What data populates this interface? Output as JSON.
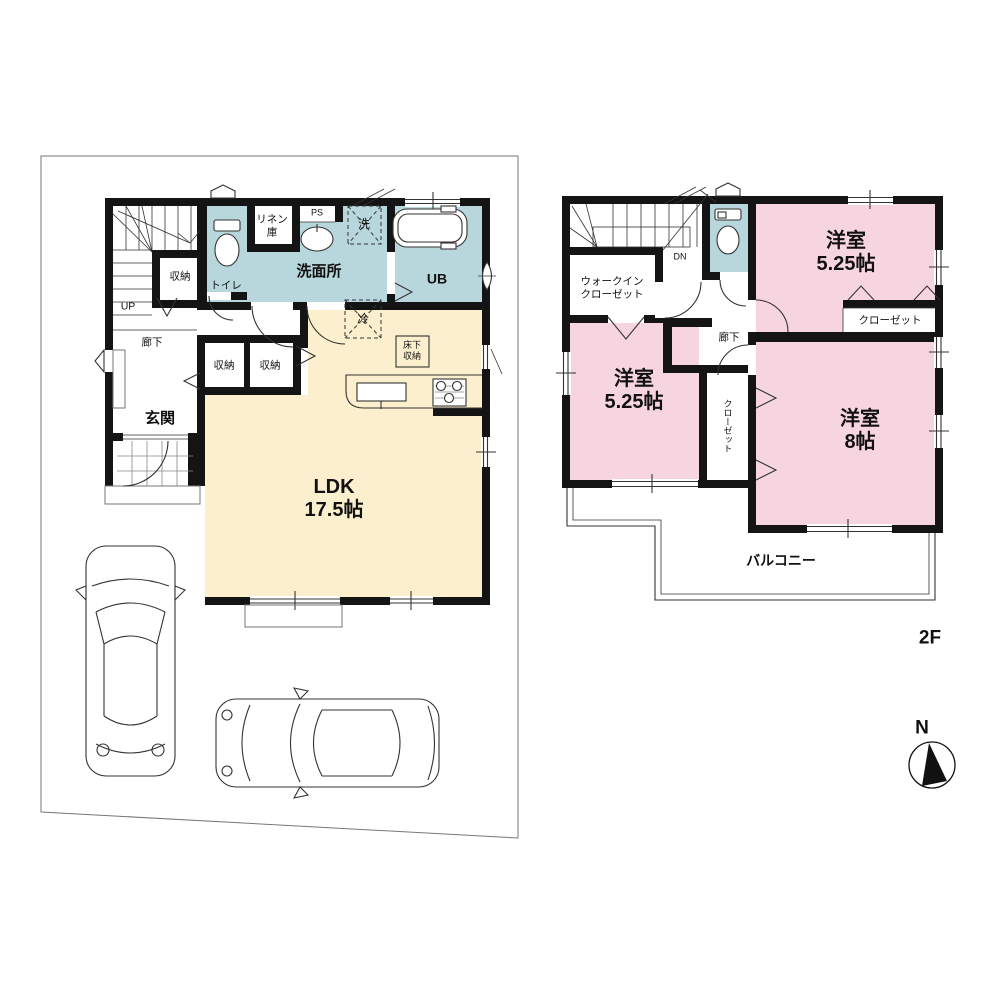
{
  "colors": {
    "wall": "#141414",
    "wet": "#b8d7dd",
    "ldk": "#fcefcd",
    "bedroom": "#f6d4e0"
  },
  "floor1": {
    "linen_closet": "リネン\n庫",
    "pipe_space": "PS",
    "washing_machine": "洗",
    "unit_bath": "UB",
    "washroom": "洗面所",
    "toilet": "トイレ",
    "stair_storage": "収納",
    "stairs_up": "UP",
    "hallway": "廊下",
    "hall_storage_1": "収納",
    "hall_storage_2": "収納",
    "entrance": "玄関",
    "refrigerator": "冷",
    "underfloor_storage": "床下\n収納",
    "ldk": "LDK\n17.5帖"
  },
  "floor2": {
    "stairs_down": "DN",
    "walk_in_closet": "ウォークイン\nクローゼット",
    "bedroom_a": "洋室\n5.25帖",
    "closet_a": "クローゼット",
    "hallway": "廊下",
    "bedroom_b": "洋室\n5.25帖",
    "closet_b": "クローゼット",
    "bedroom_c": "洋室\n8帖",
    "balcony": "バルコニー",
    "floor_label": "2F"
  },
  "compass": {
    "north": "N"
  }
}
